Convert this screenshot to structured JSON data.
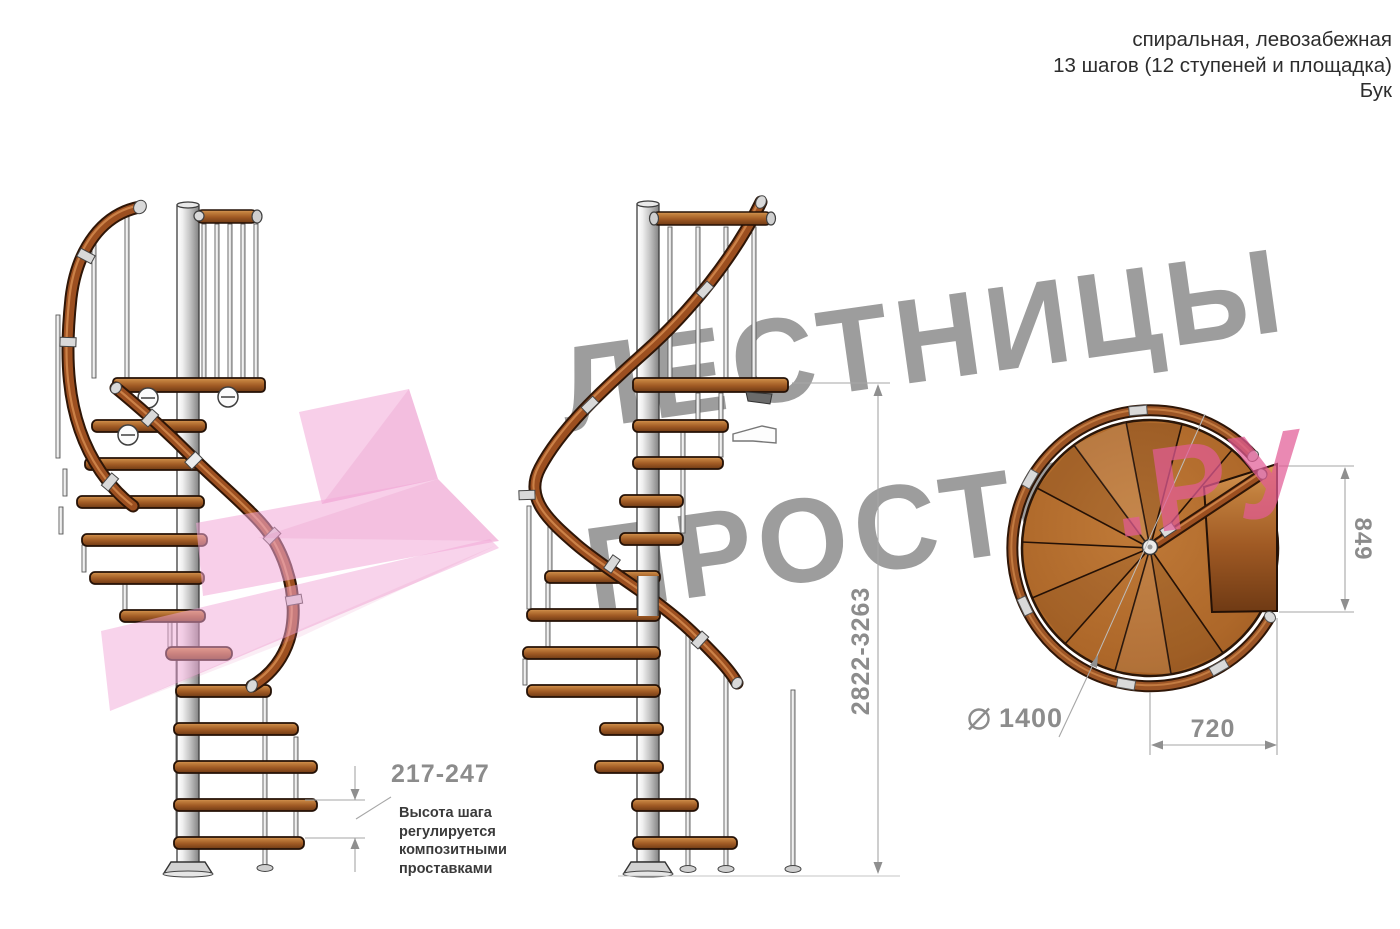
{
  "header": {
    "line1": "спиральная, левозабежная",
    "line2": "13 шагов (12 ступеней и площадка)",
    "line3": "Бук"
  },
  "watermark": {
    "line1": "ЛЕСТНИЦЫ",
    "line2_main": "ПРОСТО",
    "line2_accent": ".РУ",
    "gray_color": "#9d9d9d",
    "accent_color": "#e25b95",
    "arrow_color": "#f2a8d7"
  },
  "dimensions": {
    "step_height": {
      "value": "217-247",
      "note": "Высота шага\nрегулируется\nкомпозитными\nпроставками"
    },
    "total_height": {
      "value": "2822-3263"
    },
    "platform_depth": {
      "value": "849"
    },
    "diameter": {
      "symbol": "⌀",
      "value": "1400"
    },
    "platform_width": {
      "value": "720"
    }
  },
  "palette": {
    "wood_light": "#d99a58",
    "wood_mid": "#a05a24",
    "wood_dark": "#6f3a14",
    "rail_outline": "#2f1607",
    "rail_wood": "#9c4f20",
    "rail_highlight": "#d38a4f",
    "metal_light": "#f0f0f0",
    "metal_dark": "#808080",
    "outline": "#241106",
    "dimension_gray": "#8c8c8c",
    "note_color": "#3a3a3a"
  }
}
